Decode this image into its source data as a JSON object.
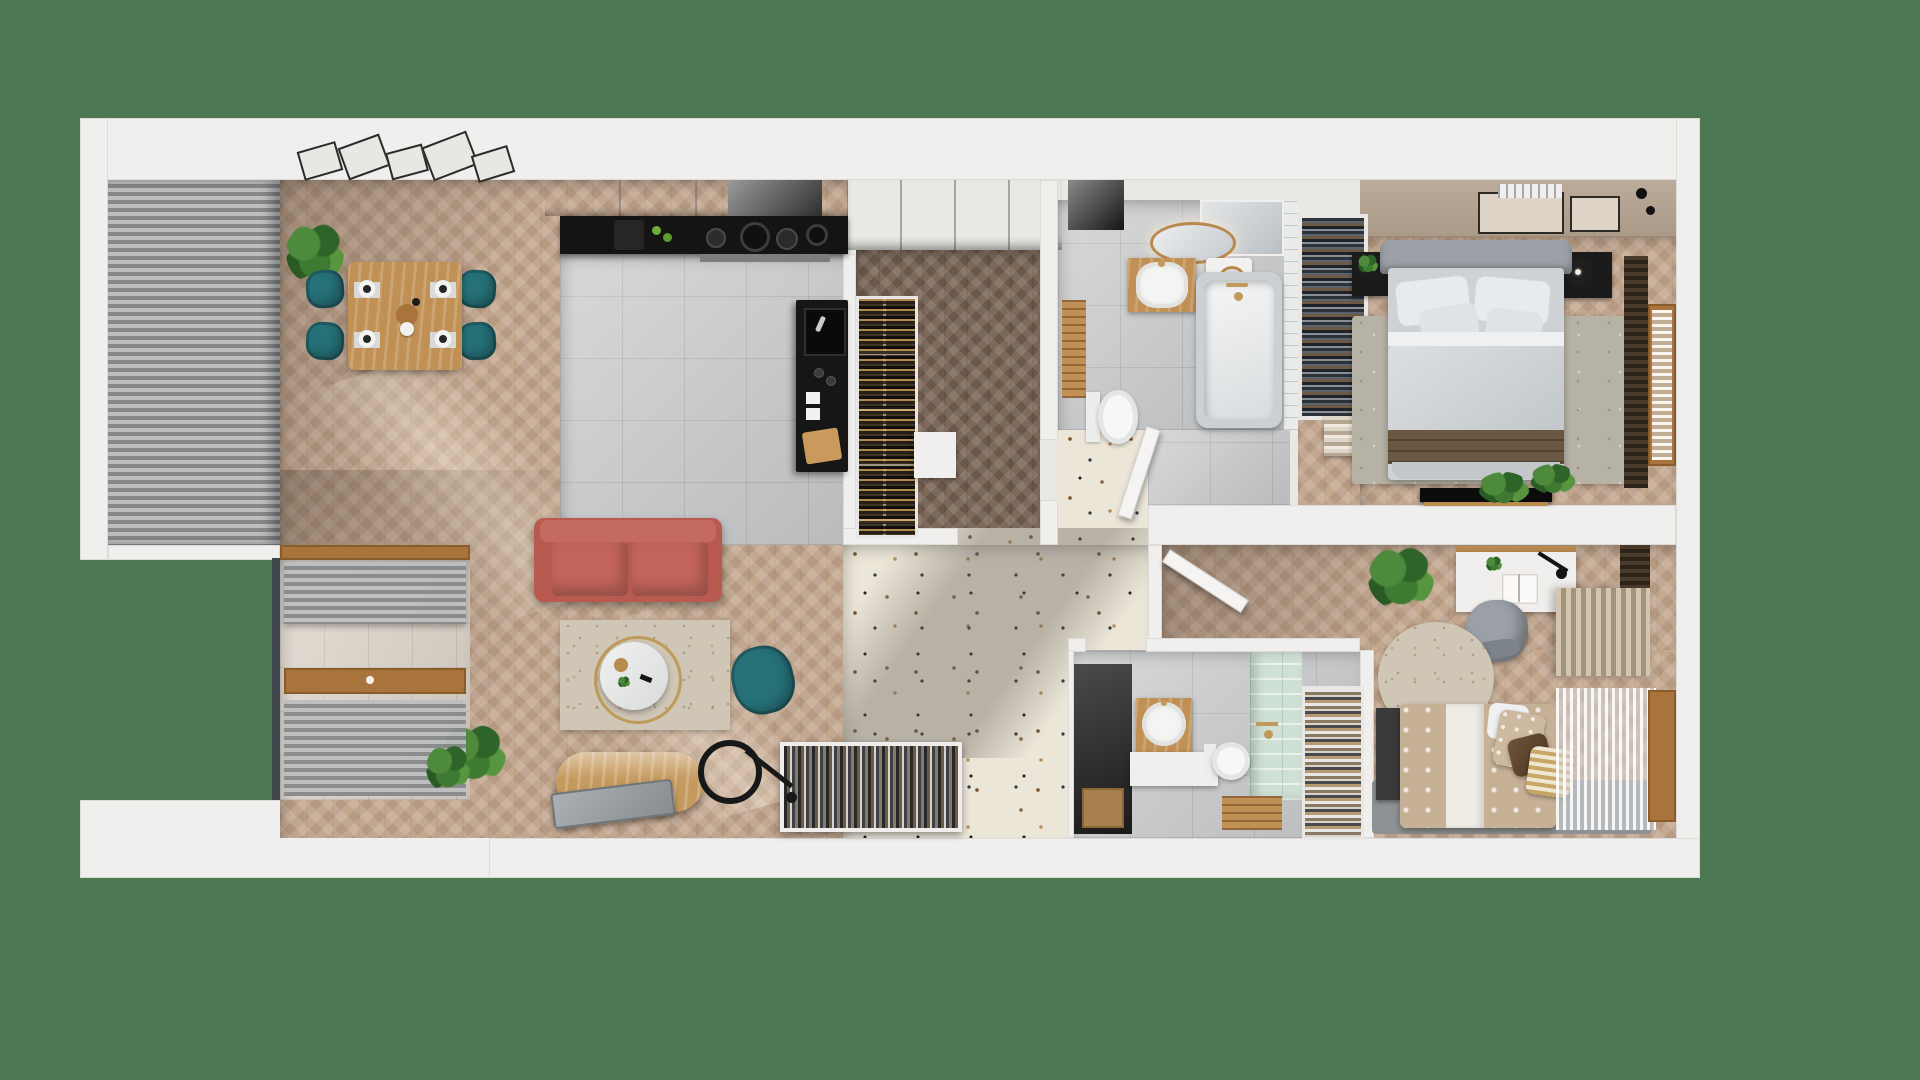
{
  "scene": {
    "title": "Apartment 3D floor plan render",
    "background_color": "#4d7952"
  },
  "palette": {
    "background_green": "#4d7952",
    "wall_white": "#f0efed",
    "wood_floor_light": "#c3a78f",
    "wood_floor_dark": "#7e6a5b",
    "tile_gray": "#c7c9cb",
    "terrazzo_cream": "#ece6d9",
    "balcony_tile": "#d8cfc3",
    "mint_tile": "#cfe0d4",
    "bedroom_wall_tan": "#b4a290",
    "accent_teal": "#267078",
    "accent_coral": "#b85a4f",
    "wood_furniture": "#c09055",
    "counter_black": "#141414",
    "blinds_gray": "#a9abad",
    "curtain_brown": "#4a3a2c",
    "brass_gold": "#c09a58"
  },
  "rooms": {
    "dining": {
      "label": "Dining area"
    },
    "kitchen": {
      "label": "Kitchen"
    },
    "living": {
      "label": "Living room"
    },
    "balcony": {
      "label": "Balcony"
    },
    "corridor": {
      "label": "Corridor with closet"
    },
    "hall": {
      "label": "Entrance hall"
    },
    "bathroom_main": {
      "label": "Main bathroom"
    },
    "bedroom_main": {
      "label": "Master bedroom"
    },
    "bedroom_second": {
      "label": "Second bedroom with desk"
    },
    "bathroom_shower": {
      "label": "Shower bathroom"
    }
  },
  "furniture": {
    "dining_table": "Oak dining table with four place settings",
    "dining_chair": "Teal dining chair",
    "gallery_frames": "Gallery picture frames",
    "plant": "Potted green plant",
    "wall_cabinets": "Kitchen upper cabinets",
    "cooktop_counter": "Black countertop with hob and pots",
    "kitchen_island": "Black island with sink",
    "wine_rack": "Wine bottle rack",
    "closet": "Built-in closet",
    "sofa": "Coral three-seat sofa",
    "rug_living": "Beige area rug",
    "coffee_table": "Round white coffee table with brass ring",
    "armchair": "Teal armchair",
    "tv_console": "Oval oak TV console",
    "leaning_tv": "TV panel",
    "floor_lamp": "Black ring floor lamp",
    "shoe_cabinet": "Open shoe cabinet",
    "shoe_rack_tall": "Tall shoe rack",
    "mirror_round": "Round brass mirror",
    "mirror_cabinet": "Mirrored cabinet",
    "vanity_main": "Wood vanity with round basin",
    "washing_machine": "Washing machine",
    "bench_slatted": "Slatted wood bench",
    "toilet": "Wall-hung toilet",
    "bathtub": "Bathtub with brass fittings",
    "wardrobe_open": "Open wardrobe with hanging clothes",
    "folded_clothes": "Folded clothes stack",
    "bed_main": "Double bed with gray bedding and brown throw",
    "nightstand_plant": "Black nightstand with plant",
    "nightstand_lamp": "Black nightstand with round lamp",
    "tv_bedroom": "Wall-mounted TV with shelf",
    "rug_bedroom": "Gray bedroom rug",
    "frames_bedroom": "Two picture frames",
    "ceiling_vent": "Ceiling vent grille",
    "wall_lights": "Black wall lights",
    "window_blinds": "Gray louvre blinds",
    "window_wood": "Wood framed window with sheer curtain",
    "curtain_brown": "Dark brown louvre curtain",
    "curtain_beige": "Pleated beige curtain",
    "desk": "White desk with lamp and open book",
    "desk_chair": "Gray desk chair",
    "rug_round": "Round beige rug",
    "bed_single": "Single bed with patterned duvet and cushions",
    "bed_bench": "Dark bedside bench",
    "rug_dark": "Dark gray rug",
    "vanity_shower": "Wood vanity cube with round basin",
    "shower_mint": "Sage tiled shower wall",
    "wood_crate": "Wood crate",
    "storage_niche": "Dark storage niche with box",
    "door_leaf": "Open white door",
    "balcony_sill": "Wood window sill",
    "glass_edge": "Balcony glazing edge"
  }
}
